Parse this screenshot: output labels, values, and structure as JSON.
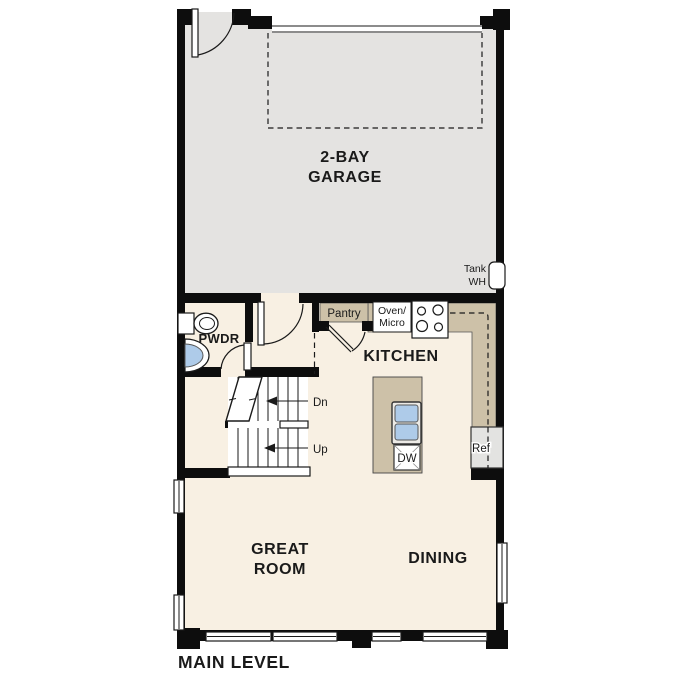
{
  "title": "MAIN LEVEL",
  "colors": {
    "wall": "#0d0d0d",
    "garage_floor": "#e4e3e1",
    "living_floor": "#f8f0e3",
    "counter_tan": "#cdc1a8",
    "sink_blue": "#aecbe9",
    "appliance_gray": "#e3e3e1"
  },
  "rooms": {
    "garage": {
      "label_line1": "2-BAY",
      "label_line2": "GARAGE"
    },
    "kitchen": {
      "label": "KITCHEN"
    },
    "great_room": {
      "label_line1": "GREAT",
      "label_line2": "ROOM"
    },
    "dining": {
      "label": "DINING"
    },
    "powder_room": {
      "label": "PWDR"
    }
  },
  "fixtures": {
    "water_heater": {
      "label_line1": "Tank",
      "label_line2": "WH"
    },
    "pantry": {
      "label": "Pantry"
    },
    "oven_micro": {
      "label_line1": "Oven/",
      "label_line2": "Micro"
    },
    "dishwasher": {
      "label": "DW"
    },
    "refrigerator": {
      "label": "Ref"
    }
  },
  "stairs": {
    "down_label": "Dn",
    "up_label": "Up"
  }
}
